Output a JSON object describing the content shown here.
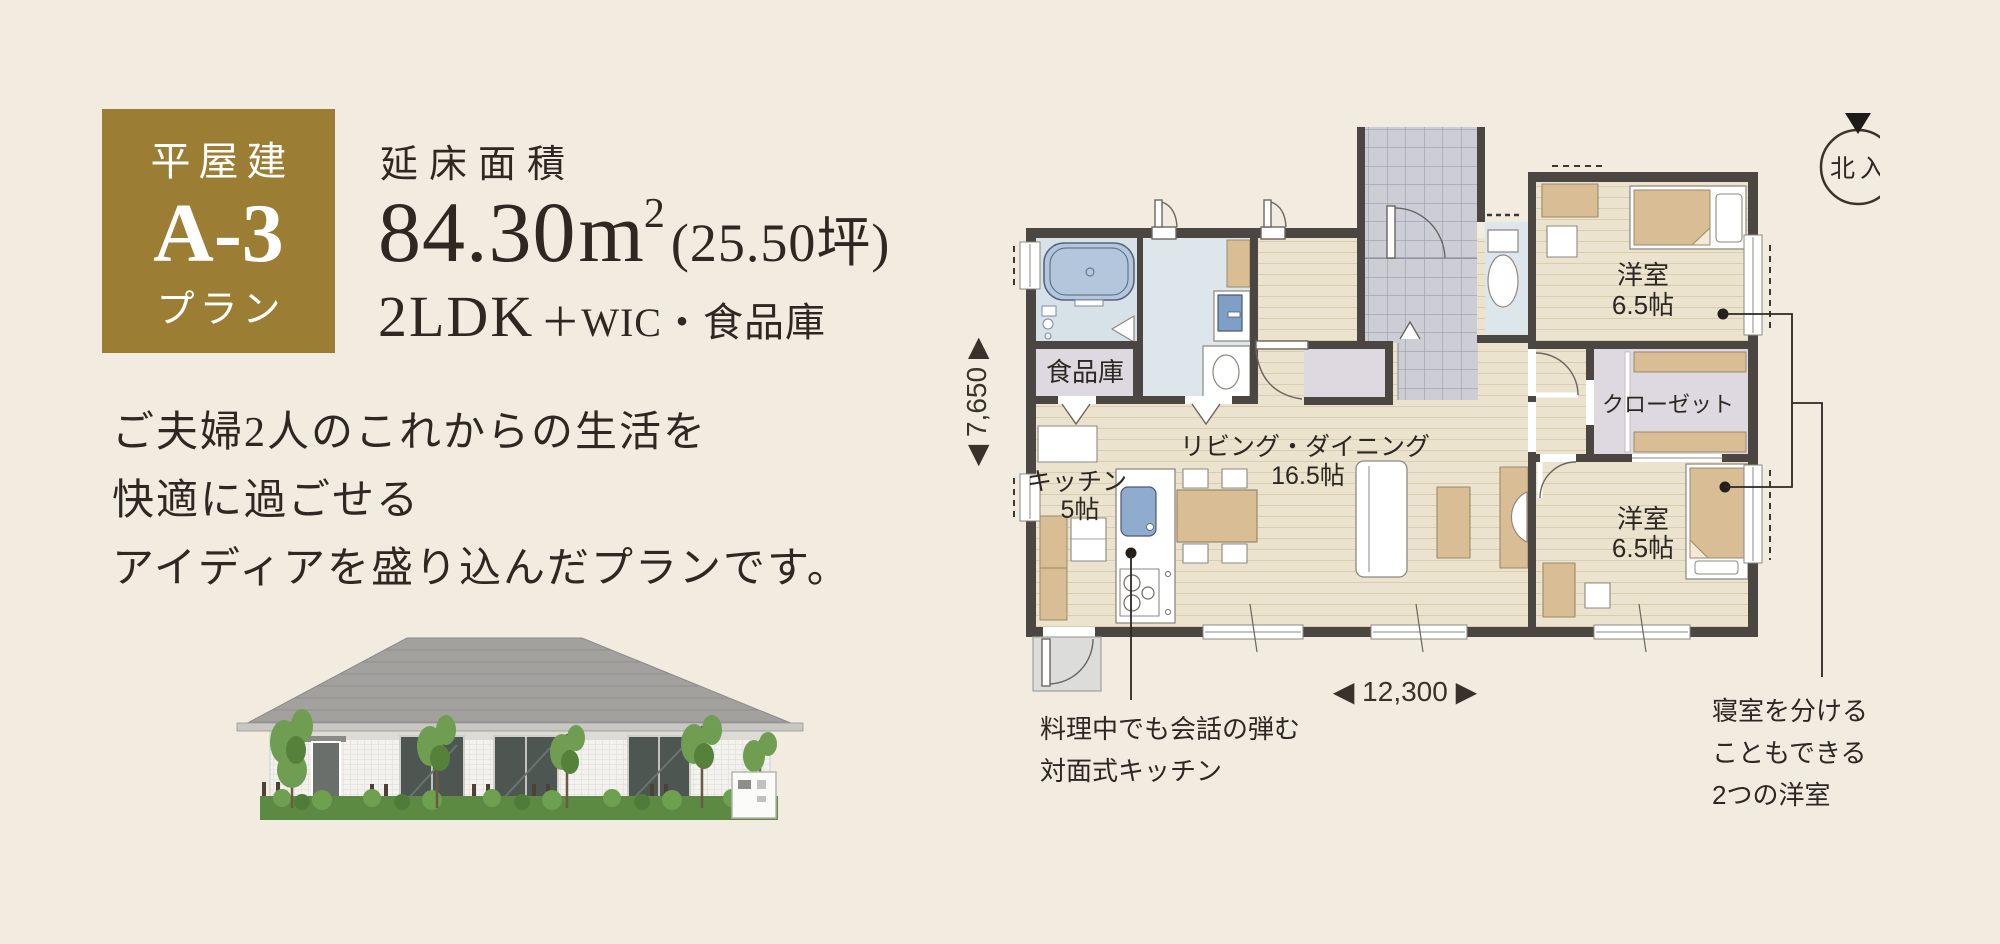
{
  "page": {
    "bg": "#f1ecdf"
  },
  "badge": {
    "building_type": "平屋建",
    "plan_code": "A-3",
    "plan_suffix": "プラン",
    "bg": "#9b7d33"
  },
  "area": {
    "label": "延床面積",
    "value": "84.30",
    "unit": "m",
    "unit_exp": "2",
    "tsubo": "(25.50坪)",
    "layout": "2LDK",
    "layout_extra": "＋WIC・食品庫"
  },
  "description": {
    "line1": "ご夫婦2人のこれからの生活を",
    "line2": "快適に過ごせる",
    "line3": "アイディアを盛り込んだプランです。"
  },
  "compass": {
    "label": "北入"
  },
  "dimensions": {
    "horizontal": "◀ 12,300 ▶",
    "vertical": "◀ 7,650 ▶"
  },
  "floorplan": {
    "pantry": "食品庫",
    "kitchen": "キッチン",
    "kitchen_size": "5帖",
    "living": "リビング・ダイニング",
    "living_size": "16.5帖",
    "bedroom1": "洋室",
    "bedroom1_size": "6.5帖",
    "closet": "クローゼット",
    "bedroom2": "洋室",
    "bedroom2_size": "6.5帖"
  },
  "callouts": {
    "kitchen": {
      "line1": "料理中でも会話の弾む",
      "line2": "対面式キッチン"
    },
    "bedrooms": {
      "line1": "寝室を分ける",
      "line2": "こともできる",
      "line3": "2つの洋室"
    }
  },
  "colors": {
    "accent_gold": "#9b7d33",
    "background": "#f1ecdf",
    "wall": "#4b4642",
    "wood_floor": "#ebe3cd",
    "wet_room": "#dde6eb",
    "storage_room": "#ded8e0",
    "tile": "#cdcdd5",
    "furniture_wood": "#d8bd95",
    "text": "#2f2822"
  }
}
